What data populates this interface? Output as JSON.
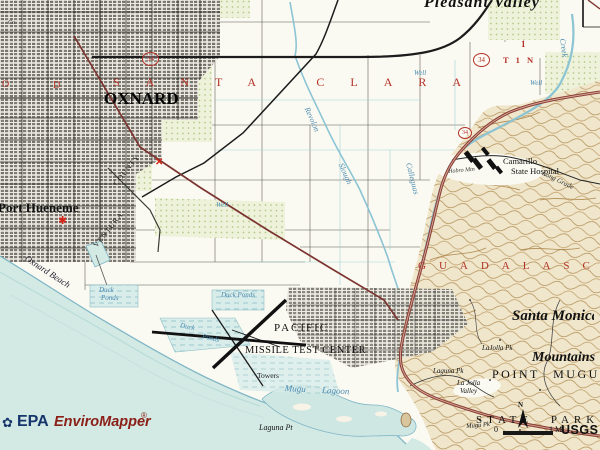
{
  "labels": {
    "co_fragment": "Co",
    "pleasant_valley": "Pleasant Valley",
    "grant_o": "O",
    "grant_d": "D",
    "santa_clara": "SANTA CLARA",
    "oxnard": "OXNARD",
    "port_hueneme": "Port Hueneme",
    "oxnard_beach": "Oxnard Beach",
    "ventura_rail": "VENTURA",
    "county_rail": "COUNTY",
    "well": "Well",
    "revolon": "Revolon",
    "slough": "Slough",
    "calleguas": "Calleguas",
    "creek": "Creek",
    "camarillo": "Camarillo",
    "state_hospital": "State Hospital",
    "hobro": "Hobro Mtn",
    "long_grade": "Long Grade",
    "guadalasca": "GUADALASCA",
    "duck": "Duck",
    "ponds": "Ponds",
    "duck_ponds": "Duck Ponds",
    "pacific": "PACIFIC",
    "missile_test_center": "MISSILE TEST CENTER",
    "towers": "Towers",
    "mugu_lagoon": "Mugu Lagoon",
    "laguna_pt": "Laguna Pt",
    "santa_monica": "Santa Monica",
    "mountains": "Mountains",
    "point_mugu": "POINT MUGU",
    "lajolla_pk": "LaJolla Pk",
    "laguna_pk": "Laguna Pk",
    "la_jolla": "La Jolla",
    "valley": "Valley",
    "mugu_pk": "Mugu Pk",
    "state_park": "STATE PARK",
    "t1n": "T 1 N",
    "section_1": "1"
  },
  "route_shields": {
    "route_34": "34"
  },
  "markers": {
    "epa_site_star": "✱",
    "epa_site_x": "✕"
  },
  "compass": {
    "n": "N"
  },
  "scale_bar": {
    "zero": "0",
    "one_mile": "1 MI"
  },
  "attribution": {
    "epa": "EPA",
    "enviromapper": "EnviroMapper",
    "registered": "®",
    "usgs": "USGS"
  },
  "icons": {
    "epa_flower": "✿"
  },
  "palette": {
    "paper": "#fbfaf2",
    "ocean": "#d3e9e4",
    "shoreline": "#7fb6c6",
    "hills_bg": "#efe6cb",
    "hills_contour": "#bf9c66",
    "orchard_dot": "#b3c98a",
    "urban_block": "#807d74",
    "road": "#1c1c1c",
    "railroad": "#7c3430",
    "highway": "#8a4036",
    "stream": "#8cc4d4",
    "red_label": "#b33227",
    "blue_label": "#4a8bb0",
    "marker_red": "#d42316",
    "epa_blue": "#16356b",
    "enviromapper_red": "#8a2017"
  }
}
